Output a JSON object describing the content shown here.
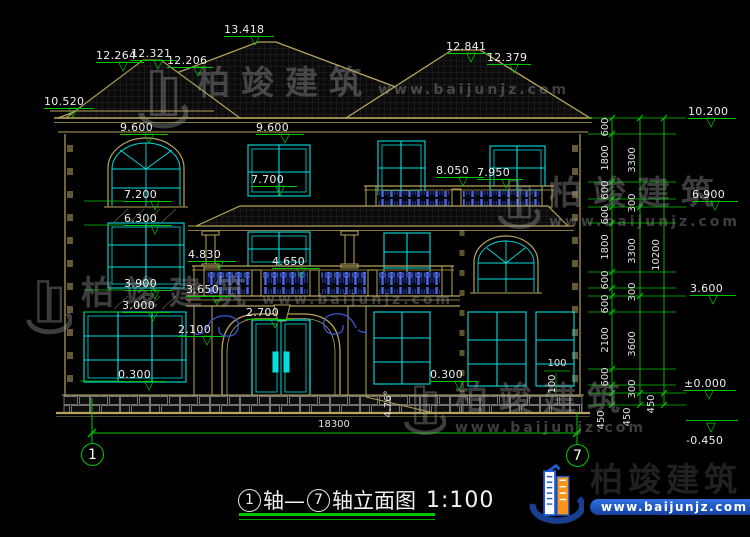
{
  "colors": {
    "background": "#000000",
    "outline_tan": "#b7a35c",
    "window_cyan": "#00dede",
    "dimension_green": "#00c800",
    "balustrade_blue": "#3a57d6",
    "text_white": "#efefef",
    "logo_blue": "#1d5dd0",
    "logo_orange": "#f7941d"
  },
  "title": {
    "axis_start": "1",
    "joiner": "轴—",
    "axis_end": "7",
    "suffix": "轴立面图",
    "scale": "1:100"
  },
  "axes": {
    "left": "1",
    "right": "7"
  },
  "company": {
    "name": "柏竣建筑",
    "url": "www.baijunjz.com"
  },
  "watermarks": [
    {
      "text": "柏竣建筑",
      "url": "www.baijunjz.com"
    },
    {
      "text": "柏竣建筑",
      "url": "www.baijunjz.com"
    },
    {
      "text": "柏竣建筑",
      "url": "www.baijunjz.com"
    },
    {
      "text": "柏竣建筑",
      "url": "www.baijunjz.com"
    }
  ],
  "elevation_markers": [
    {
      "label": "13.418",
      "x": 224,
      "y": 24,
      "w": 50,
      "t": 26
    },
    {
      "label": "12.264",
      "x": 96,
      "y": 50,
      "w": 48,
      "t": 22
    },
    {
      "label": "12.321",
      "x": 131,
      "y": 48,
      "w": 46,
      "t": 22
    },
    {
      "label": "12.206",
      "x": 167,
      "y": 55,
      "w": 46,
      "t": 26
    },
    {
      "label": "12.841",
      "x": 446,
      "y": 41,
      "w": 46,
      "t": 20
    },
    {
      "label": "12.379",
      "x": 487,
      "y": 52,
      "w": 44,
      "t": 22
    },
    {
      "label": "10.520",
      "x": 44,
      "y": 96,
      "w": 50,
      "t": 24
    },
    {
      "label": "9.600",
      "x": 120,
      "y": 122,
      "w": 48,
      "t": 24
    },
    {
      "label": "9.600",
      "x": 256,
      "y": 122,
      "w": 48,
      "t": 24
    },
    {
      "label": "10.200",
      "x": 688,
      "y": 106,
      "w": 48,
      "t": 18
    },
    {
      "label": "7.700",
      "x": 251,
      "y": 174,
      "w": 46,
      "t": 24
    },
    {
      "label": "8.050",
      "x": 436,
      "y": 165,
      "w": 48,
      "t": 22
    },
    {
      "label": "7.950",
      "x": 477,
      "y": 167,
      "w": 46,
      "t": 24
    },
    {
      "label": "7.200",
      "x": 124,
      "y": 189,
      "w": 48,
      "t": 26
    },
    {
      "label": "6.900",
      "x": 692,
      "y": 189,
      "w": 46,
      "t": 18
    },
    {
      "label": "6.300",
      "x": 124,
      "y": 213,
      "w": 48,
      "t": 26
    },
    {
      "label": "4.830",
      "x": 188,
      "y": 249,
      "w": 48,
      "t": 26
    },
    {
      "label": "4.650",
      "x": 272,
      "y": 256,
      "w": 48,
      "t": 24
    },
    {
      "label": "3.900",
      "x": 124,
      "y": 278,
      "w": 48,
      "t": 26
    },
    {
      "label": "3.650",
      "x": 186,
      "y": 284,
      "w": 46,
      "t": 26
    },
    {
      "label": "3.600",
      "x": 690,
      "y": 283,
      "w": 46,
      "t": 18
    },
    {
      "label": "3.000",
      "x": 122,
      "y": 300,
      "w": 48,
      "t": 26
    },
    {
      "label": "2.700",
      "x": 246,
      "y": 307,
      "w": 48,
      "t": 24
    },
    {
      "label": "2.100",
      "x": 178,
      "y": 324,
      "w": 46,
      "t": 24
    },
    {
      "label": "0.300",
      "x": 118,
      "y": 369,
      "w": 48,
      "t": 26
    },
    {
      "label": "0.300",
      "x": 430,
      "y": 369,
      "w": 48,
      "t": 24
    },
    {
      "label": "±0.000",
      "x": 684,
      "y": 378,
      "w": 52,
      "t": 20
    },
    {
      "label": "-0.450",
      "x": 686,
      "y": 419,
      "w": 52,
      "t": 20,
      "flip": true
    }
  ],
  "dimensions": [
    {
      "text": "600",
      "x": 606,
      "y": 127,
      "rot": true
    },
    {
      "text": "1800",
      "x": 606,
      "y": 158,
      "rot": true
    },
    {
      "text": "600",
      "x": 606,
      "y": 190,
      "rot": true
    },
    {
      "text": "600",
      "x": 606,
      "y": 215,
      "rot": true
    },
    {
      "text": "1800",
      "x": 606,
      "y": 247,
      "rot": true
    },
    {
      "text": "600",
      "x": 606,
      "y": 280,
      "rot": true
    },
    {
      "text": "600",
      "x": 606,
      "y": 304,
      "rot": true
    },
    {
      "text": "2100",
      "x": 606,
      "y": 340,
      "rot": true
    },
    {
      "text": "600",
      "x": 606,
      "y": 377,
      "rot": true
    },
    {
      "text": "450",
      "x": 602,
      "y": 420,
      "rot": true
    },
    {
      "text": "3300",
      "x": 633,
      "y": 160,
      "rot": true
    },
    {
      "text": "300",
      "x": 633,
      "y": 203,
      "rot": true
    },
    {
      "text": "3300",
      "x": 633,
      "y": 251,
      "rot": true
    },
    {
      "text": "300",
      "x": 633,
      "y": 292,
      "rot": true
    },
    {
      "text": "3600",
      "x": 633,
      "y": 344,
      "rot": true
    },
    {
      "text": "300",
      "x": 633,
      "y": 389,
      "rot": true
    },
    {
      "text": "450",
      "x": 628,
      "y": 417,
      "rot": true
    },
    {
      "text": "10200",
      "x": 657,
      "y": 255,
      "rot": true
    },
    {
      "text": "450",
      "x": 652,
      "y": 404,
      "rot": true
    },
    {
      "text": "100",
      "x": 557,
      "y": 364,
      "rot": false
    },
    {
      "text": "100",
      "x": 553,
      "y": 384,
      "rot": true
    },
    {
      "text": "4.76°",
      "x": 389,
      "y": 404,
      "rot": true
    },
    {
      "text": "18300",
      "x": 334,
      "y": 425,
      "rot": false
    }
  ]
}
